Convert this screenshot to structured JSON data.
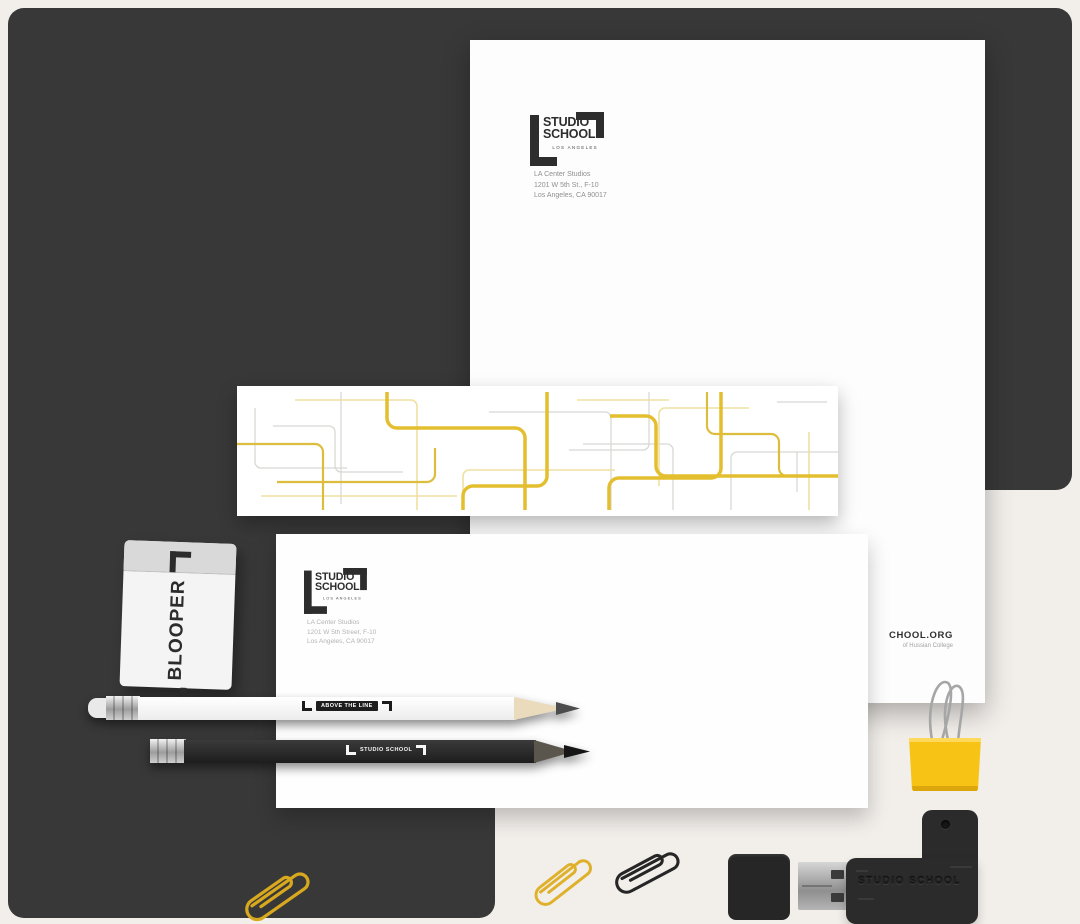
{
  "brand": {
    "line1": "STUDIO",
    "line2": "SCHOOL",
    "city": "LOS ANGELES"
  },
  "letterhead": {
    "address": [
      "LA Center Studios",
      "1201 W 5th St., F-10",
      "Los Angeles, CA 90017"
    ],
    "website_visible": "CHOOL.ORG",
    "tagline_visible": "of Hussian College"
  },
  "envelope": {
    "address": [
      "LA Center Studios",
      "1201 W 5th Street, F-10",
      "Los Angeles, CA 90017"
    ]
  },
  "eraser": {
    "label": "BLOOPER"
  },
  "pencils": {
    "white_label": "ABOVE THE LINE",
    "black_label": "STUDIO SCHOOL"
  },
  "usb": {
    "label": "STUDIO SCHOOL"
  },
  "colors": {
    "accent_yellow": "#F5C415",
    "panel_dark": "#383838",
    "background_cream": "#F2EEEA",
    "paper_white": "#FDFDFD",
    "logo_black": "#2D2D2D"
  }
}
